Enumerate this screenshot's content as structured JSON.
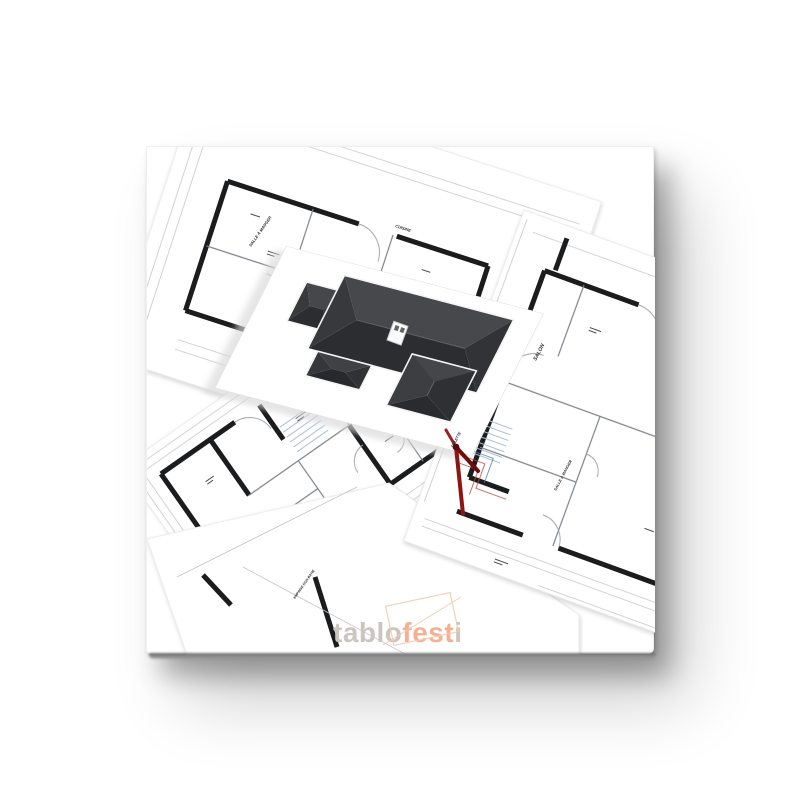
{
  "page": {
    "background": "#ffffff"
  },
  "canvas_print": {
    "description": "3D house model standing on architectural blueprints (canvas print mockup)",
    "watermark": {
      "part1": "tablo",
      "part2": "fest",
      "part3": "i"
    }
  },
  "colors": {
    "roof_top": "#46484c",
    "roof_bottom": "#2b2d30",
    "roof_left": "#38393d",
    "roof_right": "#313337",
    "wing_left": "#3c3e42",
    "wing_right": "#2e3034",
    "wing_top": "#44464a",
    "wing_bottom": "#292b2e",
    "wall_ink": "#1b1c1e",
    "partition_gray": "#7d838a",
    "dim_gray": "#c3c7cb",
    "stair_blue": "#aabfd3",
    "wire_red": "#c0443c",
    "wire_blue": "#4f7fae",
    "compass_red": "#8e1414",
    "compass_dark_red": "#6e0f0f",
    "compass_bright_red": "#a02020",
    "watermark_gray": "#cbc5c0",
    "watermark_orange": "#f4b091",
    "sketch_orange": "#f6c9ab"
  },
  "blueprints": {
    "labels": [
      {
        "id": "salle-a-manger-1",
        "text": "SALLE À MANGER"
      },
      {
        "id": "cuisine",
        "text": "CUISINE"
      },
      {
        "id": "salon",
        "text": "SALON"
      },
      {
        "id": "salle-a-manger-2",
        "text": "SALLE À MANGER"
      },
      {
        "id": "toilette",
        "text": "TOILETTE"
      },
      {
        "id": "emprise",
        "text": "EMPRISE NON BATIE"
      }
    ]
  }
}
